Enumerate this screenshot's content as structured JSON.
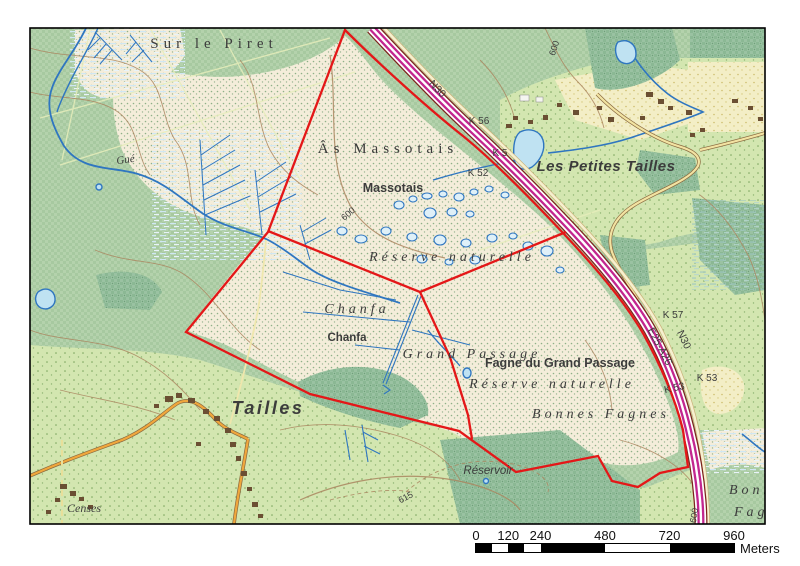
{
  "map": {
    "labels": [
      {
        "name": "sur-le-piret",
        "text": "Sur le Piret",
        "x": 214,
        "y": 48,
        "cls": "serif-lg"
      },
      {
        "name": "as-massotais",
        "text": "Âs Massotais",
        "x": 388,
        "y": 153,
        "cls": "serif-lg"
      },
      {
        "name": "reserve-naturelle-north",
        "text": "Réserve naturelle",
        "x": 452,
        "y": 261,
        "cls": "serif-md"
      },
      {
        "name": "chanfa-toponym",
        "text": "Chanfa",
        "x": 357,
        "y": 313,
        "cls": "serif-md"
      },
      {
        "name": "grand-passage",
        "text": "Grand Passage",
        "x": 472,
        "y": 358,
        "cls": "serif-md"
      },
      {
        "name": "reserve-naturelle-south",
        "text": "Réserve naturelle",
        "x": 552,
        "y": 388,
        "cls": "serif-md"
      },
      {
        "name": "bonnes-fagnes",
        "text": "Bonnes Fagnes",
        "x": 601,
        "y": 418,
        "cls": "serif-md"
      },
      {
        "name": "bonnes-clipped",
        "text": "Bonnes",
        "x": 729,
        "y": 494,
        "cls": "serif-md anchor-start"
      },
      {
        "name": "fagnes-clipped",
        "text": "Fagnes",
        "x": 734,
        "y": 516,
        "cls": "serif-md anchor-start"
      },
      {
        "name": "censes",
        "text": "Censes",
        "x": 84,
        "y": 512,
        "cls": "serif-sm"
      },
      {
        "name": "tailles",
        "text": "Tailles",
        "x": 268,
        "y": 414,
        "cls": "village-lg"
      },
      {
        "name": "les-petites-tailles",
        "text": "Les Petites Tailles",
        "x": 606,
        "y": 171,
        "cls": "village-md"
      },
      {
        "name": "massotais-red",
        "text": "Massotais",
        "x": 393,
        "y": 192,
        "cls": "red-md"
      },
      {
        "name": "chanfa-red",
        "text": "Chanfa",
        "x": 347,
        "y": 341,
        "cls": "red-sm"
      },
      {
        "name": "fagne-du-grand-passage-red",
        "text": "Fagne du Grand Passage",
        "x": 560,
        "y": 367,
        "cls": "red-md"
      },
      {
        "name": "gue-stream",
        "text": "Gué",
        "x": 126,
        "y": 163,
        "rot": -8,
        "cls": "water-sm"
      },
      {
        "name": "reservoir",
        "text": "Réservoir",
        "x": 488,
        "y": 474,
        "cls": "teal-sm"
      },
      {
        "name": "n30-north",
        "text": "N30",
        "x": 435,
        "y": 91,
        "rot": 47,
        "cls": "road"
      },
      {
        "name": "n30-south",
        "text": "N30",
        "x": 681,
        "y": 341,
        "rot": 65,
        "cls": "road"
      },
      {
        "name": "e25-a26",
        "text": "E25-A26",
        "x": 657,
        "y": 348,
        "rot": 62,
        "cls": "road"
      },
      {
        "name": "k56-marker",
        "text": "K 56",
        "x": 479,
        "y": 124,
        "cls": "road-sm"
      },
      {
        "name": "k5-marker",
        "text": "K 5",
        "x": 500,
        "y": 156,
        "cls": "road-sm"
      },
      {
        "name": "k52-marker",
        "text": "K 52",
        "x": 478,
        "y": 176,
        "cls": "road-sm"
      },
      {
        "name": "k57-marker",
        "text": "K 57",
        "x": 673,
        "y": 318,
        "cls": "road-sm"
      },
      {
        "name": "k53-marker-east",
        "text": "K 53",
        "x": 707,
        "y": 381,
        "cls": "road-sm"
      },
      {
        "name": "k53-marker-west",
        "text": "K 53",
        "x": 675,
        "y": 391,
        "rot": -12,
        "cls": "road-sm"
      },
      {
        "name": "contour-600-top",
        "text": "600",
        "x": 557,
        "y": 49,
        "rot": -72,
        "cls": "contour"
      },
      {
        "name": "contour-600-mid",
        "text": "600",
        "x": 350,
        "y": 216,
        "rot": -40,
        "cls": "contour"
      },
      {
        "name": "contour-615",
        "text": "615",
        "x": 407,
        "y": 500,
        "rot": -28,
        "cls": "contour"
      },
      {
        "name": "contour-600-bottom",
        "text": "600",
        "x": 697,
        "y": 516,
        "rot": -80,
        "cls": "contour"
      }
    ]
  },
  "scalebar": {
    "ticks": [
      0,
      120,
      240,
      480,
      720,
      960
    ],
    "segment_bounds_m": [
      0,
      60,
      120,
      180,
      240,
      480,
      720,
      960
    ],
    "unit": "Meters",
    "length_m": 960
  },
  "colors": {
    "boundary_red": "#e41718",
    "motorway_magenta": "#c2268f",
    "motorway_casing": "#7c241c",
    "water_blue": "#2f76c0",
    "pond_fill": "#bfe2f2",
    "red_label": "#d40000",
    "teal_label": "#2a9d9d",
    "contour_brown": "#ab8660",
    "forest_green": "#b4d2ac",
    "field_green": "#d3e6b0",
    "moor_cream": "#f4edda",
    "road_orange": "#f0a73c"
  }
}
